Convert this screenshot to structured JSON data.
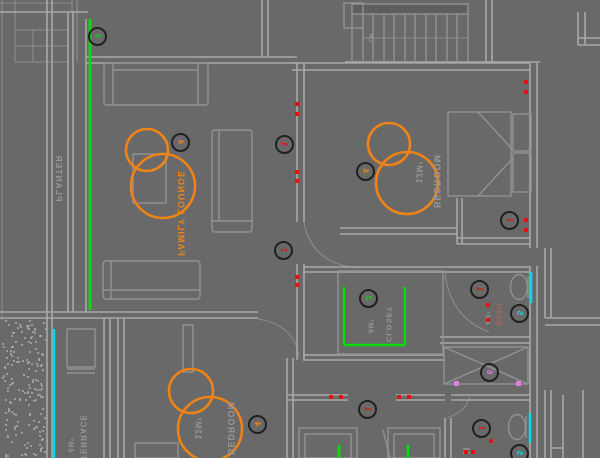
{
  "labels": {
    "planter": "PLANTER",
    "family_lounge": "FAMILY LOUNGE",
    "bedroom_top": "BEDROOM",
    "bedroom_top_area": "12M²",
    "closet": "CLOSET",
    "closet_area": "4M²",
    "bath": "BATH",
    "bath_area": "4M²",
    "terrace": "TERRACE",
    "terrace_area": "4M²",
    "bedroom_bottom": "BEDROOM",
    "bedroom_bottom_area": "12M²",
    "deck_tag": "CH"
  },
  "keynotes": [
    {
      "num": "3",
      "color": "#19c819",
      "x": 96,
      "y": 35
    },
    {
      "num": "4",
      "color": "#ef8318",
      "x": 179,
      "y": 141
    },
    {
      "num": "1",
      "color": "#e31212",
      "x": 283,
      "y": 143
    },
    {
      "num": "4",
      "color": "#ef8318",
      "x": 364,
      "y": 170
    },
    {
      "num": "1",
      "color": "#e31212",
      "x": 282,
      "y": 249
    },
    {
      "num": "1",
      "color": "#e31212",
      "x": 508,
      "y": 219
    },
    {
      "num": "3",
      "color": "#19c819",
      "x": 367,
      "y": 297
    },
    {
      "num": "1",
      "color": "#e31212",
      "x": 478,
      "y": 288
    },
    {
      "num": "5",
      "color": "#27c6d6",
      "x": 518,
      "y": 312
    },
    {
      "num": "6",
      "color": "#e07be0",
      "x": 488,
      "y": 371
    },
    {
      "num": "4",
      "color": "#ef8318",
      "x": 256,
      "y": 423
    },
    {
      "num": "1",
      "color": "#e31212",
      "x": 366,
      "y": 408
    },
    {
      "num": "1",
      "color": "#e31212",
      "x": 480,
      "y": 427
    },
    {
      "num": "5",
      "color": "#27c6d6",
      "x": 518,
      "y": 452
    }
  ],
  "electrical": {
    "outlet_dots": [
      [
        297,
        104
      ],
      [
        297,
        114
      ],
      [
        297,
        172
      ],
      [
        297,
        181
      ],
      [
        297,
        277
      ],
      [
        297,
        285
      ],
      [
        526,
        82
      ],
      [
        526,
        92
      ],
      [
        526,
        220
      ],
      [
        526,
        230
      ],
      [
        331,
        397
      ],
      [
        341,
        397
      ],
      [
        399,
        397
      ],
      [
        409,
        397
      ],
      [
        488,
        305
      ],
      [
        488,
        320
      ],
      [
        491,
        441
      ],
      [
        466,
        452
      ],
      [
        473,
        452
      ]
    ]
  },
  "magenta_markers": [
    [
      456,
      383
    ],
    [
      518,
      383
    ]
  ],
  "colors": {
    "background": "#696969",
    "line_gray": "#a8a8a8",
    "highlight_green": "#07dd07",
    "window_cyan": "#00d9e9",
    "fixture_orange": "#ef8318",
    "outlet_red": "#e31212",
    "marker_magenta": "#e87ae8"
  }
}
